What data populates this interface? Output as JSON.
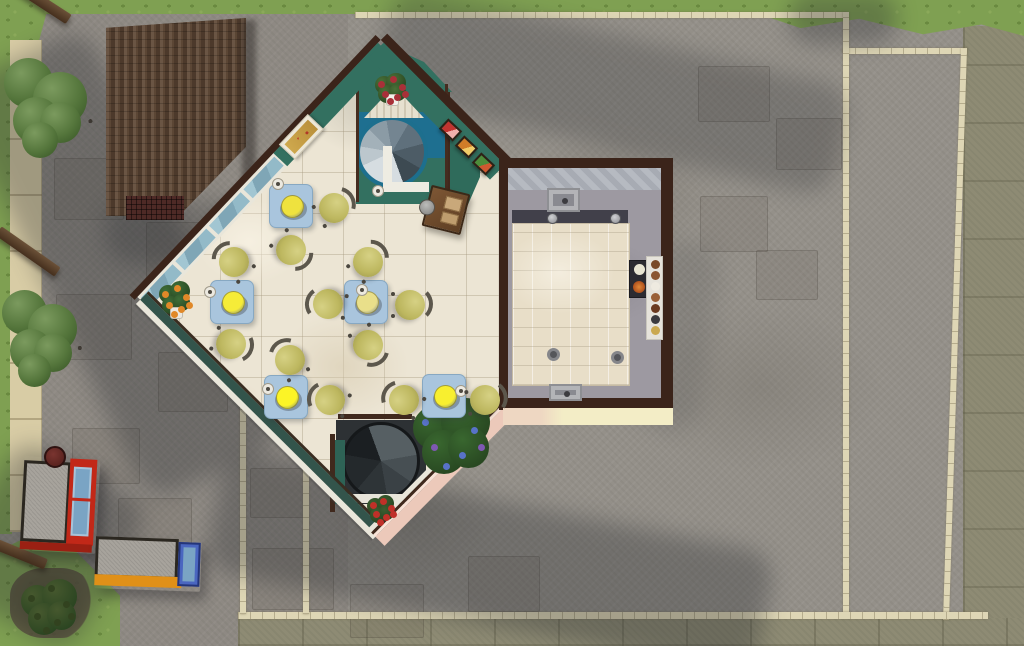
{
  "meta": {
    "scene": "overhead-floorplan-view-of-diner-lot",
    "rooms": [
      "dining-room-diamond",
      "kitchen"
    ],
    "no_visible_text": true
  },
  "palette": {
    "pavement": "#949089",
    "grass": "#7fa052",
    "street": "#8e8b74",
    "sand": "#d8cca5",
    "border": "#ded6b5",
    "floor": "#ece5d4",
    "teal": "#337060",
    "tealdark": "#33544b",
    "wallbrown": "#3b241a",
    "trim": "#e9e6da",
    "pink": "#ecc9ba",
    "cream": "#f3edc6",
    "kfloor": "#9d99a1",
    "island": "#e8dec8",
    "cloth": "#a9c5dd",
    "chair_seat": "#bdb75f",
    "plate_bright": "#fcf426",
    "window_glass": "#8ab0bf",
    "roof_shingle": "#5b4635",
    "stair_rail_blue": "#1d6f8e"
  },
  "objects": {
    "tables": [
      {
        "x": 269,
        "y": 184,
        "plate": "#efe23e",
        "cup": [
          2,
          -7
        ]
      },
      {
        "x": 210,
        "y": 280,
        "plate": "#f6ec38",
        "cup": [
          -7,
          5
        ]
      },
      {
        "x": 344,
        "y": 280,
        "plate": "#e9df8a",
        "cup": [
          11,
          3
        ]
      },
      {
        "x": 264,
        "y": 375,
        "plate": "#fcf426",
        "cup": [
          -3,
          7
        ]
      },
      {
        "x": 422,
        "y": 374,
        "plate": "#f8ef2f",
        "cup": [
          32,
          10
        ]
      }
    ],
    "chairs": [
      [
        334,
        208,
        60
      ],
      [
        291,
        250,
        135
      ],
      [
        234,
        262,
        -45
      ],
      [
        368,
        262,
        45
      ],
      [
        328,
        304,
        -80
      ],
      [
        410,
        305,
        90
      ],
      [
        231,
        344,
        110
      ],
      [
        290,
        360,
        -30
      ],
      [
        368,
        345,
        150
      ],
      [
        330,
        400,
        -70
      ],
      [
        404,
        400,
        -60
      ],
      [
        485,
        400,
        80
      ]
    ],
    "standalone_cups": [
      [
        372,
        185
      ]
    ],
    "mini_paintings": [
      {
        "x": 441,
        "y": 123,
        "a": "#c23430",
        "b": "#f0b0ac"
      },
      {
        "x": 457,
        "y": 140,
        "a": "#d07c28",
        "b": "#f2cc68"
      },
      {
        "x": 474,
        "y": 157,
        "a": "#4e8c3a",
        "b": "#d05830"
      }
    ],
    "plants": [
      {
        "name": "corner-flower-pot",
        "x": 156,
        "y": 280,
        "w": 36,
        "h": 38,
        "foliage": "#3f6e38",
        "bloom": "#e08828",
        "pot": "#ece8e0"
      },
      {
        "name": "blue-flower-bush",
        "x": 406,
        "y": 396,
        "w": 88,
        "h": 82,
        "foliage": "#39672f",
        "bloom": "#5872c8",
        "bloom2": "#7e58b2"
      },
      {
        "name": "red-flower-plant",
        "x": 364,
        "y": 494,
        "w": 32,
        "h": 30,
        "foliage": "#3c5e31",
        "bloom": "#c03028"
      },
      {
        "name": "pedestal-plant",
        "x": 372,
        "y": 72,
        "w": 36,
        "h": 32,
        "foliage": "#4a7038",
        "bloom": "#a83038",
        "pot": "#f2f0ea"
      },
      {
        "name": "sapling",
        "x": 16,
        "y": 578,
        "w": 64,
        "h": 60,
        "foliage": "#46582e",
        "bloom": "#32421f"
      }
    ],
    "trees": [
      {
        "x": 2,
        "y": 52,
        "w": 90,
        "h": 100,
        "dirt": [
          40,
          84,
          72,
          62
        ]
      },
      {
        "x": 0,
        "y": 284,
        "w": 82,
        "h": 100,
        "dirt": [
          28,
          306,
          74,
          70
        ]
      }
    ],
    "beams": [
      {
        "x": 8,
        "y": -4,
        "len": 66,
        "rot": 33
      },
      {
        "x": -8,
        "y": 246,
        "len": 72,
        "rot": 35
      },
      {
        "x": -10,
        "y": 548,
        "len": 58,
        "rot": 22
      }
    ],
    "booths": [
      {
        "name": "red-frame-booth",
        "x": 22,
        "y": 458,
        "w": 76,
        "h": 94,
        "rot": 3,
        "top": "#a7a39c",
        "frame": "#c22818",
        "glass": "#7aa4c4",
        "orient": "v"
      },
      {
        "name": "yellow-frame-booth",
        "x": 95,
        "y": 538,
        "w": 106,
        "h": 52,
        "rot": 2,
        "top": "#a7a39c",
        "frame": "#e09018",
        "glass": "#4a66c0",
        "orient": "h"
      }
    ],
    "misc": [
      {
        "name": "dark-red-wheel",
        "x": 44,
        "y": 446,
        "d": 22,
        "color": "#5c2420"
      }
    ],
    "kitchen_fixtures": [
      {
        "t": "sink",
        "x": 547,
        "y": 188,
        "w": 33,
        "h": 24
      },
      {
        "t": "sink",
        "x": 549,
        "y": 384,
        "w": 33,
        "h": 17
      },
      {
        "t": "faucet",
        "x": 547,
        "y": 213
      },
      {
        "t": "faucet",
        "x": 610,
        "y": 213
      },
      {
        "t": "drain",
        "x": 547,
        "y": 348
      },
      {
        "t": "drain",
        "x": 611,
        "y": 351
      },
      {
        "t": "stove",
        "x": 629,
        "y": 260
      },
      {
        "t": "foodcol",
        "x": 646,
        "y": 256
      }
    ],
    "slabs": [
      [
        54,
        158,
        70,
        62
      ],
      [
        146,
        222,
        66,
        68
      ],
      [
        56,
        294,
        76,
        66
      ],
      [
        158,
        352,
        70,
        60
      ],
      [
        72,
        428,
        68,
        56
      ],
      [
        118,
        498,
        74,
        58
      ],
      [
        252,
        548,
        82,
        62
      ],
      [
        350,
        584,
        74,
        54
      ],
      [
        468,
        556,
        72,
        56
      ],
      [
        250,
        468,
        58,
        50
      ],
      [
        698,
        66,
        72,
        56
      ],
      [
        776,
        118,
        66,
        52
      ],
      [
        700,
        196,
        68,
        56
      ],
      [
        756,
        250,
        62,
        50
      ]
    ],
    "shadows": [
      {
        "x": -112,
        "y": 190,
        "w": 460,
        "h": 150,
        "rot": 64,
        "o": 0.3
      },
      {
        "x": 210,
        "y": 500,
        "w": 560,
        "h": 124,
        "rot": 11,
        "o": 0.3
      },
      {
        "x": 377,
        "y": 35,
        "w": 470,
        "h": 112,
        "rot": 13,
        "o": 0.24
      },
      {
        "x": 788,
        "y": -8,
        "w": 110,
        "h": 52,
        "rot": 0,
        "o": 0.3
      },
      {
        "x": 640,
        "y": 240,
        "w": 70,
        "h": 190,
        "rot": 8,
        "o": 0.12
      },
      {
        "x": -30,
        "y": 460,
        "w": 150,
        "h": 170,
        "rot": 30,
        "o": 0.3
      },
      {
        "x": 104,
        "y": 200,
        "w": 148,
        "h": 64,
        "rot": 0,
        "o": 0.25
      }
    ]
  }
}
